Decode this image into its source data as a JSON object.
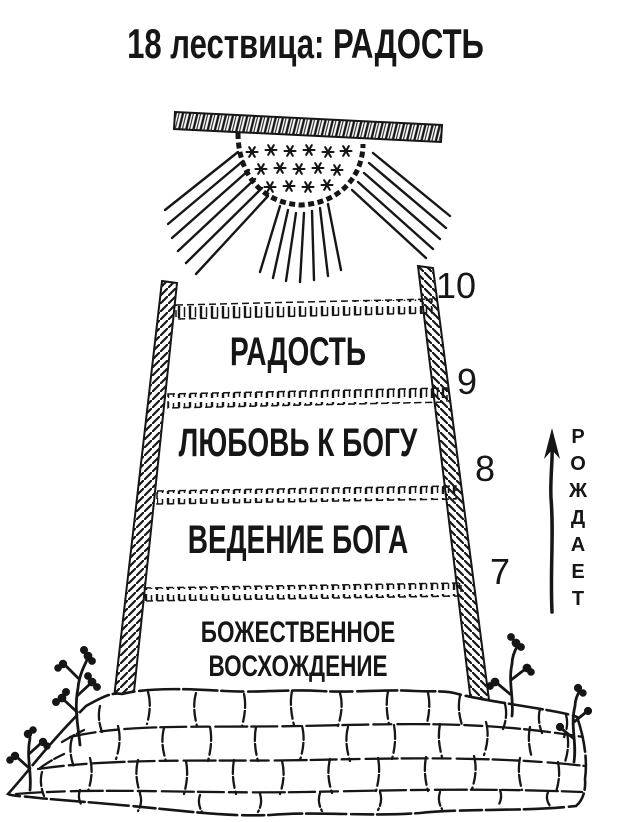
{
  "title": "18 лествица: РАДОСТЬ",
  "colors": {
    "ink": "#161616",
    "paper": "#ffffff"
  },
  "ladder": {
    "rung_numbers": [
      "10",
      "9",
      "8",
      "7"
    ],
    "levels": [
      {
        "label": "РАДОСТЬ"
      },
      {
        "label": "ЛЮБОВЬ К БОГУ"
      },
      {
        "label": "ВЕДЕНИЕ БОГА"
      }
    ],
    "base": {
      "line1": "БОЖЕСТВЕННОЕ",
      "line2": "ВОСХОЖДЕНИЕ"
    }
  },
  "arrow": {
    "label": "РОЖДАЕТ",
    "direction": "up"
  },
  "icons": {
    "sun": "half-sun-with-stars-and-rays",
    "foundation": "cobblestone-mound",
    "plants": "twig-plants"
  }
}
